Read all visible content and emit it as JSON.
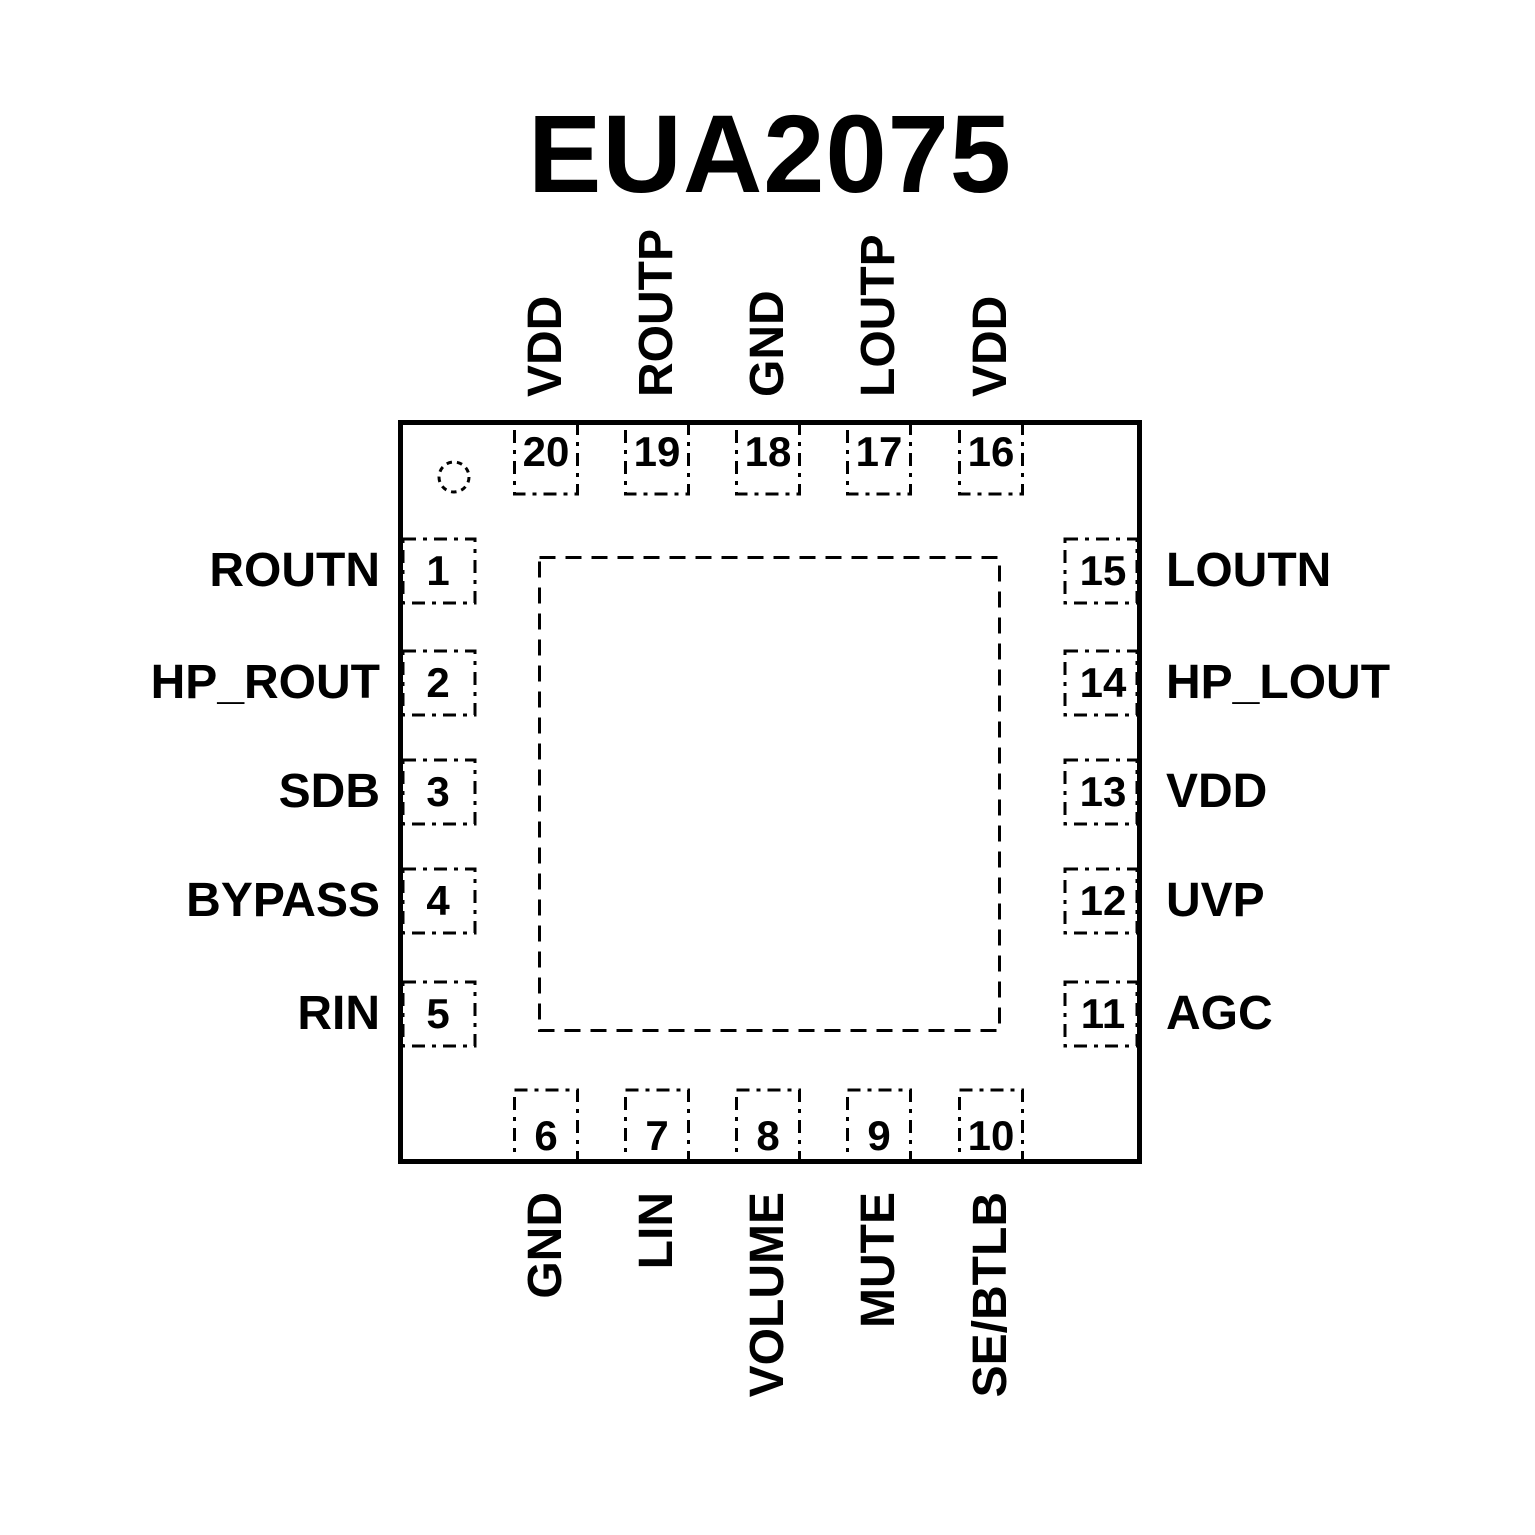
{
  "title": "EUA2075",
  "colors": {
    "ink": "#000000",
    "background": "#ffffff"
  },
  "chip": {
    "package_marks": {
      "pin1_indicator": "dashed-circle",
      "thermal_pad": "dashed-square"
    },
    "pins": {
      "top": [
        {
          "number": "20",
          "label": "VDD"
        },
        {
          "number": "19",
          "label": "ROUTP"
        },
        {
          "number": "18",
          "label": "GND"
        },
        {
          "number": "17",
          "label": "LOUTP"
        },
        {
          "number": "16",
          "label": "VDD"
        }
      ],
      "left": [
        {
          "number": "1",
          "label": "ROUTN"
        },
        {
          "number": "2",
          "label": "HP_ROUT"
        },
        {
          "number": "3",
          "label": "SDB"
        },
        {
          "number": "4",
          "label": "BYPASS"
        },
        {
          "number": "5",
          "label": "RIN"
        }
      ],
      "right": [
        {
          "number": "15",
          "label": "LOUTN"
        },
        {
          "number": "14",
          "label": "HP_LOUT"
        },
        {
          "number": "13",
          "label": "VDD"
        },
        {
          "number": "12",
          "label": "UVP"
        },
        {
          "number": "11",
          "label": "AGC"
        }
      ],
      "bottom": [
        {
          "number": "6",
          "label": "GND"
        },
        {
          "number": "7",
          "label": "LIN"
        },
        {
          "number": "8",
          "label": "VOLUME"
        },
        {
          "number": "9",
          "label": "MUTE"
        },
        {
          "number": "10",
          "label": "SE/BTLB"
        }
      ]
    }
  }
}
